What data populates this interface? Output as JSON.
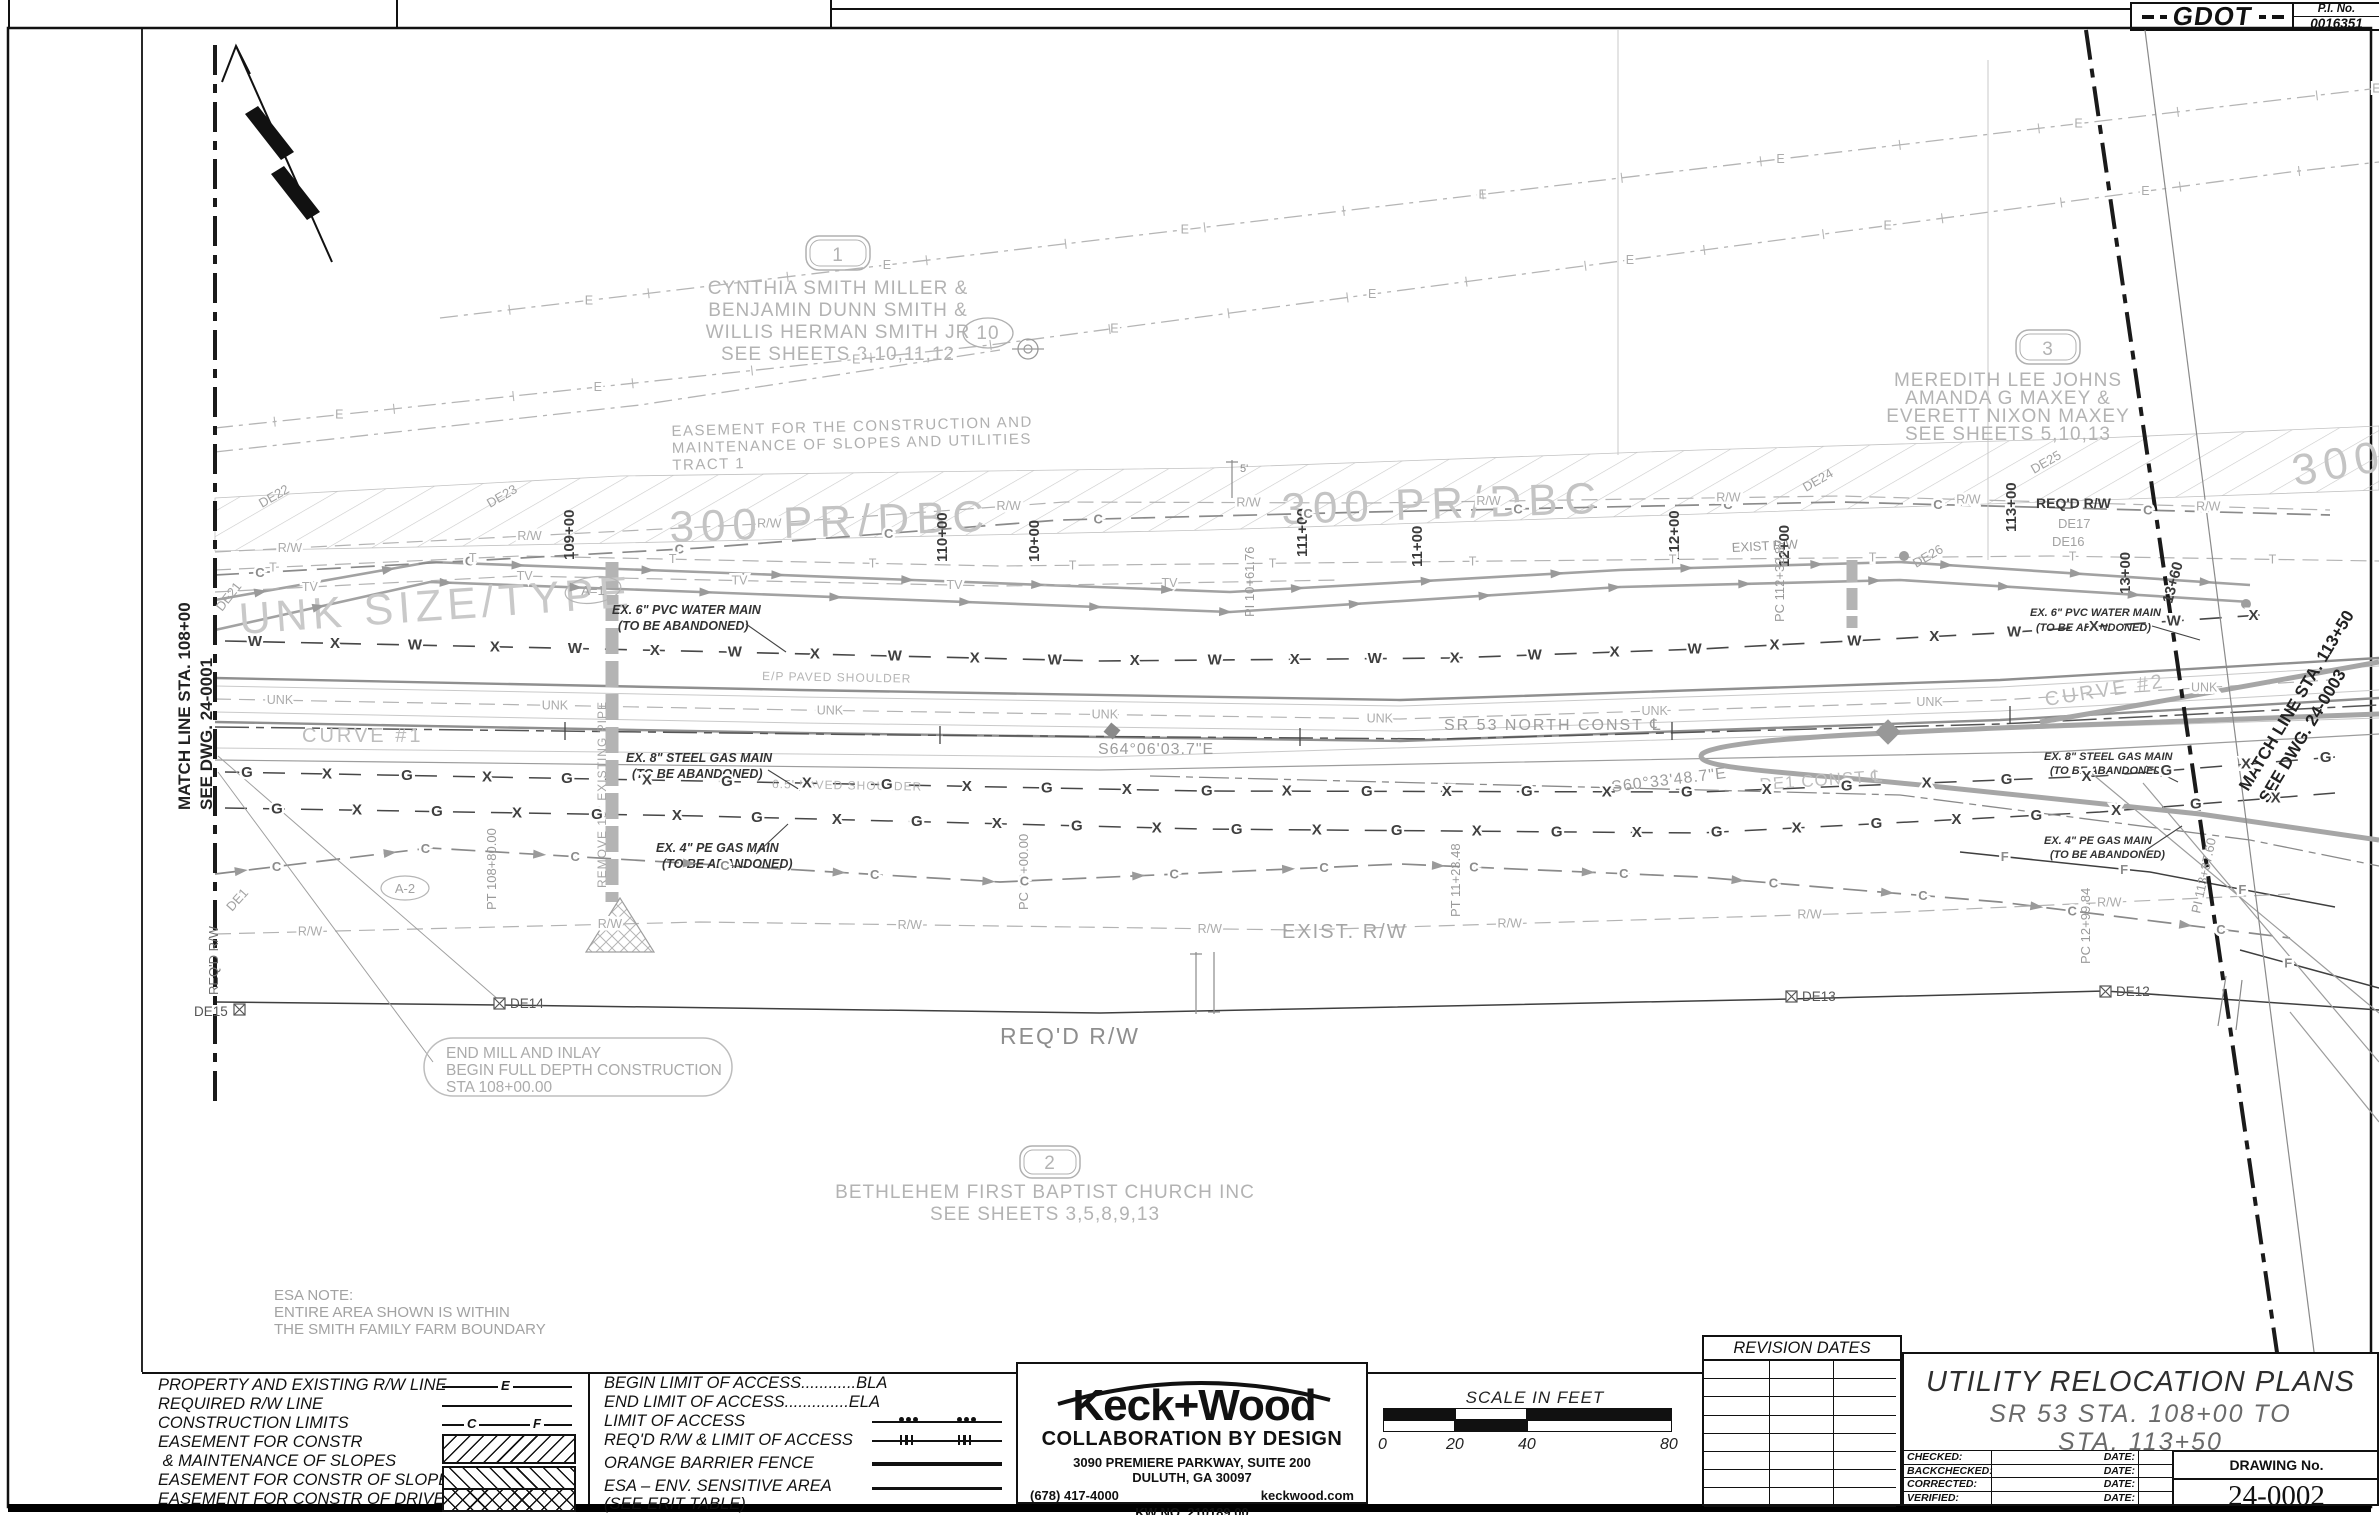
{
  "sheet": {
    "pi_label": "P.I.  No.",
    "pi_number": "0016351",
    "agency_logo": "GDOT"
  },
  "plan": {
    "match_left": [
      "MATCH LINE STA. 108+00",
      "SEE DWG. 24-0001"
    ],
    "match_right": [
      "MATCH LINE STA. 113+50",
      "SEE DWG. 24-0003"
    ],
    "parcel1": {
      "id": "1",
      "lines": [
        "CYNTHIA SMITH MILLER &",
        "BENJAMIN DUNN SMITH &",
        "WILLIS HERMAN SMITH  JR",
        "SEE SHEETS 3,10,11,12"
      ]
    },
    "parcel2": {
      "id": "2",
      "lines": [
        "BETHLEHEM FIRST BAPTIST CHURCH INC",
        "SEE SHEETS 3,5,8,9,13"
      ]
    },
    "parcel3": {
      "id": "3",
      "lines": [
        "MEREDITH LEE JOHNS",
        "AMANDA G MAXEY &",
        "EVERETT NIXON MAXEY",
        "SEE SHEETS 5,10,13"
      ]
    },
    "parcel10": "10",
    "easement_note": [
      "EASEMENT FOR THE CONSTRUCTION AND",
      "MAINTENANCE OF SLOPES AND UTILITIES",
      "TRACT 1"
    ],
    "hatch_label": "300 PR/DBC",
    "unk_label": "UNK SIZE/TYPE",
    "curve1": "CURVE #1",
    "curve2": "CURVE #2",
    "bearing1": "S64°06'03.7\"E",
    "bearing2": "S60°33'48.7\"E",
    "cl_sr53": "SR 53 NORTH CONST ℄",
    "cl_de1": "DE1 CONST ℄",
    "stations": [
      "109+00",
      "110+00",
      "111+00",
      "112+00",
      "113+00"
    ],
    "stations2": [
      "10+00",
      "11+00",
      "12+00",
      "13+00",
      "13+60"
    ],
    "pcpt": [
      "PT 108+80.00",
      "PC 10+00.00",
      "PI 10+61.76",
      "PT 11+23.48",
      "PC 112+32.87",
      "PC 12+99.84",
      "PI 113+37.60"
    ],
    "de": [
      "DE21",
      "DE22",
      "DE23",
      "DE24",
      "DE25",
      "DE26",
      "DE17",
      "DE16",
      "DE1"
    ],
    "de_boxed": [
      "DE15",
      "DE14",
      "DE13",
      "DE12"
    ],
    "callouts": {
      "a1": "A=1",
      "a2": "A-2"
    },
    "exist_rw": "EXIST. R/W",
    "exist_rw_small": "EXIST R/W",
    "reqd_rw": "REQ'D R/W",
    "end_mill": [
      "END MILL AND INLAY",
      "BEGIN FULL DEPTH CONSTRUCTION",
      "STA 108+00.00"
    ],
    "esa_note": [
      "ESA NOTE:",
      "ENTIRE AREA SHOWN IS WITHIN",
      "THE SMITH FAMILY FARM BOUNDARY"
    ],
    "abandon": {
      "water": [
        "EX. 6\" PVC WATER MAIN",
        "(TO BE ABANDONED)"
      ],
      "gas8": [
        "EX. 8\" STEEL GAS MAIN",
        "(TO BE ABANDONED)"
      ],
      "gas4": [
        "EX. 4\" PE GAS MAIN",
        "(TO BE ABANDONED)"
      ]
    },
    "shoulder1": "E/P PAVED SHOULDER",
    "shoulder2": "6.5' PAVED SHOULDER",
    "remove_pipe": "REMOVE 18\" EXISTING PIPE",
    "dim5": "5'",
    "line_labels": {
      "water": "W",
      "gas": "G",
      "comm": "C",
      "tel": "T",
      "tv": "TV",
      "cross": "X",
      "unk": "UNK",
      "rw": "R/W",
      "elec": "E",
      "fiber": "F"
    }
  },
  "legend": {
    "rows": [
      "PROPERTY AND EXISTING R/W LINE",
      "REQUIRED R/W LINE",
      "CONSTRUCTION LIMITS",
      "EASEMENT FOR CONSTR",
      " & MAINTENANCE OF SLOPES",
      "EASEMENT FOR CONSTR OF SLOPES",
      "EASEMENT FOR CONSTR OF DRIVES"
    ],
    "sym_e": "E",
    "sym_c": "C",
    "sym_f": "F"
  },
  "access": {
    "rows": [
      "BEGIN LIMIT OF ACCESS............BLA",
      "END LIMIT OF ACCESS..............ELA",
      "LIMIT OF ACCESS",
      "REQ'D R/W & LIMIT OF ACCESS",
      "ORANGE BARRIER FENCE",
      "ESA – ENV. SENSITIVE AREA",
      "(SEE ERIT TABLE)"
    ]
  },
  "firm": {
    "logo": "Keck+Wood",
    "tagline": "COLLABORATION BY DESIGN",
    "addr1": "3090 PREMIERE PARKWAY, SUITE 200",
    "addr2": "DULUTH, GA  30097",
    "phone": "(678) 417-4000",
    "web": "keckwood.com",
    "kw_no": "KW  NO.  210189.00"
  },
  "scalebar": {
    "title": "SCALE IN FEET",
    "t0": "0",
    "t20": "20",
    "t40": "40",
    "t80": "80"
  },
  "revisions": {
    "header": "REVISION DATES"
  },
  "titleblock": {
    "title": "UTILITY RELOCATION PLANS",
    "sub1": "SR 53 STA. 108+00 TO",
    "sub2": "STA. 113+50",
    "rows": [
      "CHECKED:",
      "BACKCHECKED:",
      "CORRECTED:",
      "VERIFIED:"
    ],
    "date_label": "DATE:",
    "drawing_no_label": "DRAWING No.",
    "drawing_no": "24-0002"
  }
}
